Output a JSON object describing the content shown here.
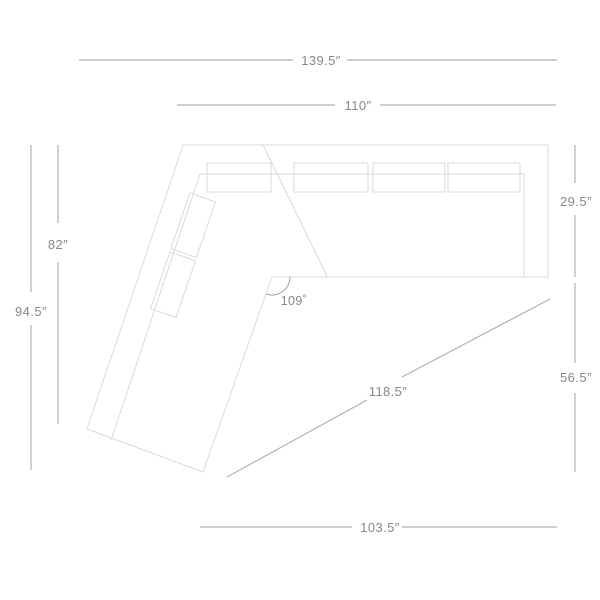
{
  "page": {
    "title": "Sectional sofa with angled chaise — top-view dimension diagram"
  },
  "labels": {
    "overall_width": "139.5″",
    "section_width": "110″",
    "seat_depth": "29.5″",
    "chaise_inner_length": "82″",
    "chaise_overall_length": "94.5″",
    "corner_angle": "109˚",
    "diagonal_length": "118.5″",
    "right_lower_height": "56.5″",
    "bottom_width": "103.5″"
  },
  "colors": {
    "background": "#ffffff",
    "sofa_outline": "#dadada",
    "dimension_line": "#b2b2b2",
    "angle_arc": "#a3a3a3",
    "label_text": "#85878b"
  }
}
